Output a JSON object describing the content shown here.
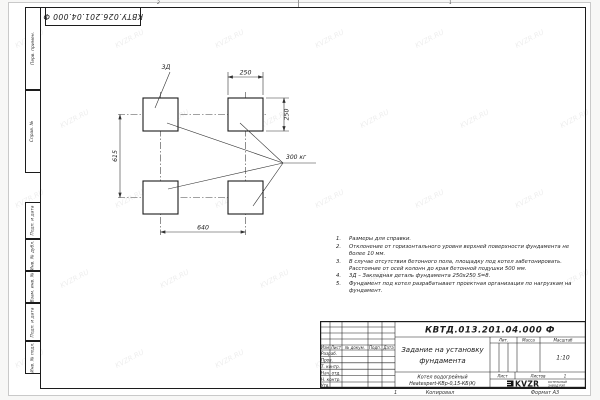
{
  "sheet": {
    "corner_stamp": "КВТУ.026.201.04.000 Ф",
    "zone_top_left": "2",
    "zone_top_right": "1",
    "zone_bottom": "1",
    "copied_label": "Копировал",
    "format_label": "Формат А3"
  },
  "margin_labels": {
    "perv_primen": "Перв. примен.",
    "sprav_no": "Справ. №",
    "podp_data_1": "Подп. и дата",
    "inv_dubl": "Инв. № дубл.",
    "vzam_inv": "Взам. инв. №",
    "podp_data_2": "Подп. и дата",
    "inv_podl": "Инв. № подл."
  },
  "drawing": {
    "embed_label": "3Д",
    "dim_top": "250",
    "dim_right": "250",
    "dim_left": "615",
    "dim_bottom": "640",
    "load_label": "300 кг"
  },
  "notes": {
    "items": [
      {
        "num": "1.",
        "text": "Размеры для справки."
      },
      {
        "num": "2.",
        "text": "Отклонение от горизонтального уровня верхней поверхности фундамента не более 10 мм."
      },
      {
        "num": "3.",
        "text": "В случае отсутствия бетонного пола, площадку под котел забетонировать. Расстояние от осей колонн до края бетонной подушки 500 мм."
      },
      {
        "num": "4.",
        "text": "3Д – Закладная деталь фундамента 250х250 S=8."
      },
      {
        "num": "5.",
        "text": "Фундамент под котел разрабатывает проектная организация по нагрузкам на фундамент."
      }
    ]
  },
  "title_block": {
    "doc_number": "КВТД.013.201.04.000 Ф",
    "title_line1": "Задание на установку",
    "title_line2": "фундамента",
    "product_line1": "Котел водогрейный",
    "product_line2": "Heatexpert-КВр-0,15-КБ(К)",
    "header": {
      "izm": "Изм",
      "list": "Лист",
      "doc": "№ докум.",
      "podp": "Подп.",
      "data": "Дата"
    },
    "rows": [
      "Разраб.",
      "Пров.",
      "Т. контр.",
      "Нач. отд.",
      "Н. контр.",
      "Утв."
    ],
    "lit_label": "Лит.",
    "mass_label": "Масса",
    "scale_label": "Масштаб",
    "scale_value": "1:10",
    "sheet_label": "Лист",
    "sheets_label": "Листов",
    "sheets_value": "1",
    "logo_text": "KVZR",
    "logo_sub1": "КОТЕЛЬНЫЙ",
    "logo_sub2": "ЗАВОД РЭП"
  },
  "watermark": {
    "text": "KVZR.RU"
  }
}
